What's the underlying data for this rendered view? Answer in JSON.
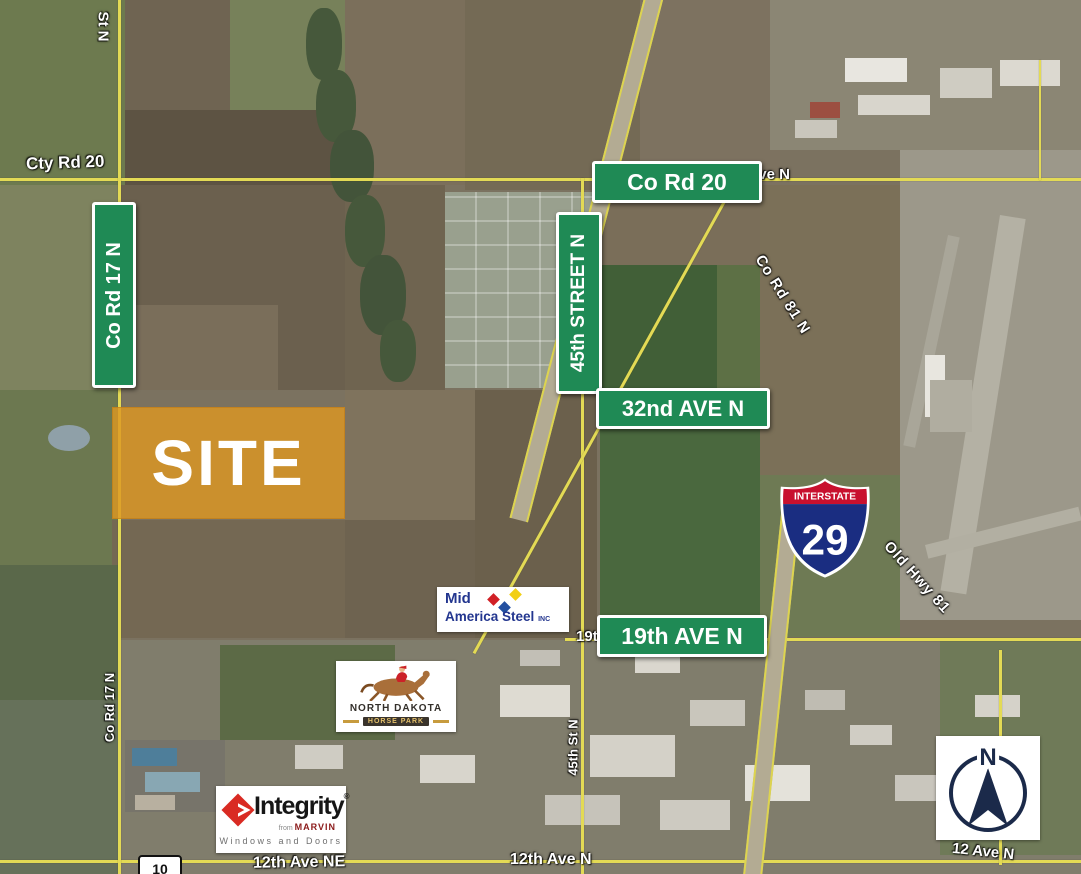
{
  "site": {
    "label": "SITE",
    "fill": "#DD9722"
  },
  "signs": {
    "co_rd_20": "Co Rd 20",
    "co_rd_17_n": "Co Rd 17 N",
    "street_45_n": "45th STREET N",
    "ave_32_n": "32nd AVE N",
    "ave_19_n": "19th AVE N"
  },
  "road_labels": {
    "cty_rd_20": "Cty Rd 20",
    "st_n": "St N",
    "ave_n": "Ave N",
    "co_rd_81_n": "Co Rd 81 N",
    "old_hwy_81": "Old Hwy 81",
    "co_rd_17_n_small": "Co Rd 17 N",
    "st_45_n_small": "45th St N",
    "ave_19_partial": "19t",
    "ave_12_ne": "12th Ave NE",
    "ave_12_n": "12th Ave N",
    "ave_12_n_right": "12 Ave N",
    "route_10": "10"
  },
  "interstate_shield": {
    "top_label": "INTERSTATE",
    "number": "29",
    "red": "#C8102E",
    "blue": "#1A2D81"
  },
  "logos": {
    "mid_america_steel": {
      "line1": "Mid",
      "line2": "America Steel",
      "suffix": "INC"
    },
    "nd_horse_park": {
      "title": "NORTH DAKOTA",
      "subtitle": "HORSE PARK"
    },
    "integrity": {
      "name": "Integrity",
      "reg": "®",
      "from": "from",
      "brand": "MARVIN",
      "tagline": "Windows and Doors"
    }
  },
  "compass": {
    "label": "N"
  },
  "colors": {
    "sign_green": "#1F8A55",
    "road_yellow": "#E3DA55",
    "compass_navy": "#1B2A4A",
    "site_orange": "#DD9722"
  }
}
